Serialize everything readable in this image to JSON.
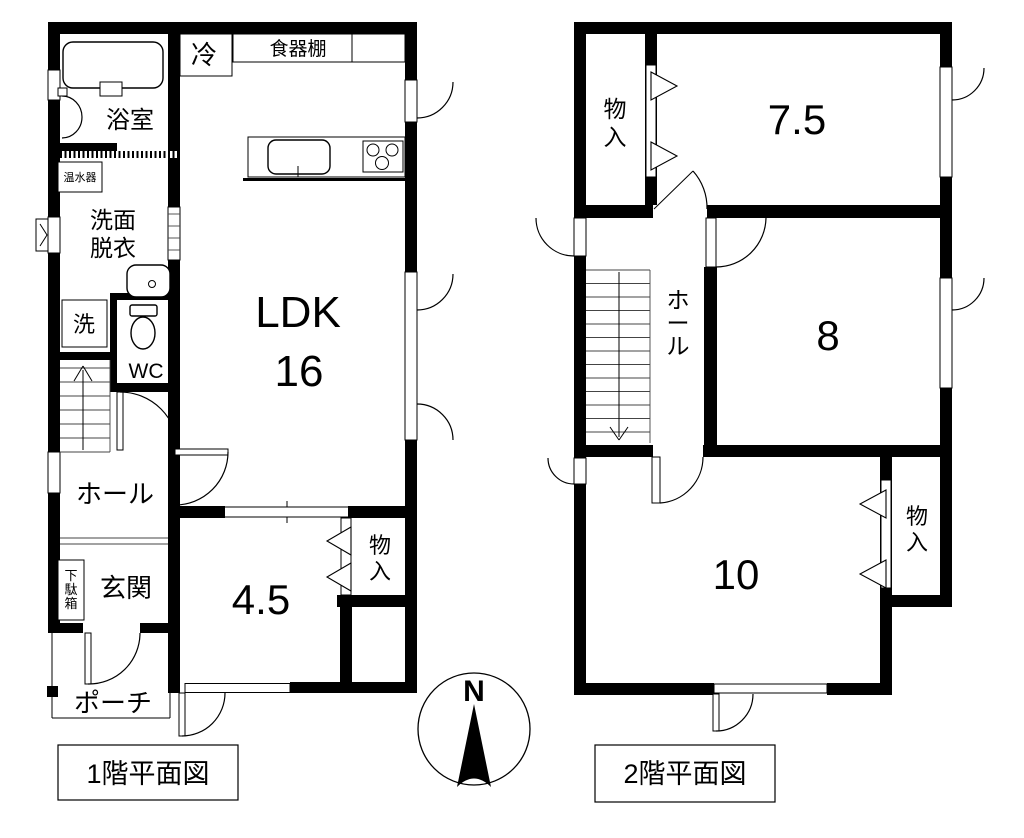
{
  "floor1": {
    "caption": "1階平面図",
    "bath": "浴室",
    "fridge": "冷",
    "cupboard": "食器棚",
    "water_heater": "温水器",
    "wash1": "洗面",
    "wash2": "脱衣",
    "laundry": "洗",
    "wc": "WC",
    "ldk": "LDK",
    "ldk_size": "16",
    "hall": "ホール",
    "entrance": "玄関",
    "shoe": [
      "下",
      "駄",
      "箱"
    ],
    "room45": "4.5",
    "storage": [
      "物",
      "入"
    ],
    "porch": "ポーチ"
  },
  "floor2": {
    "caption": "2階平面図",
    "storage_top": [
      "物",
      "入"
    ],
    "room75": "7.5",
    "hall": [
      "ホ",
      "ー",
      "ル"
    ],
    "room8": "8",
    "room10": "10",
    "storage_bottom": [
      "物",
      "入"
    ]
  },
  "compass": {
    "north": "N"
  },
  "colors": {
    "line": "#000000",
    "background": "#ffffff"
  }
}
